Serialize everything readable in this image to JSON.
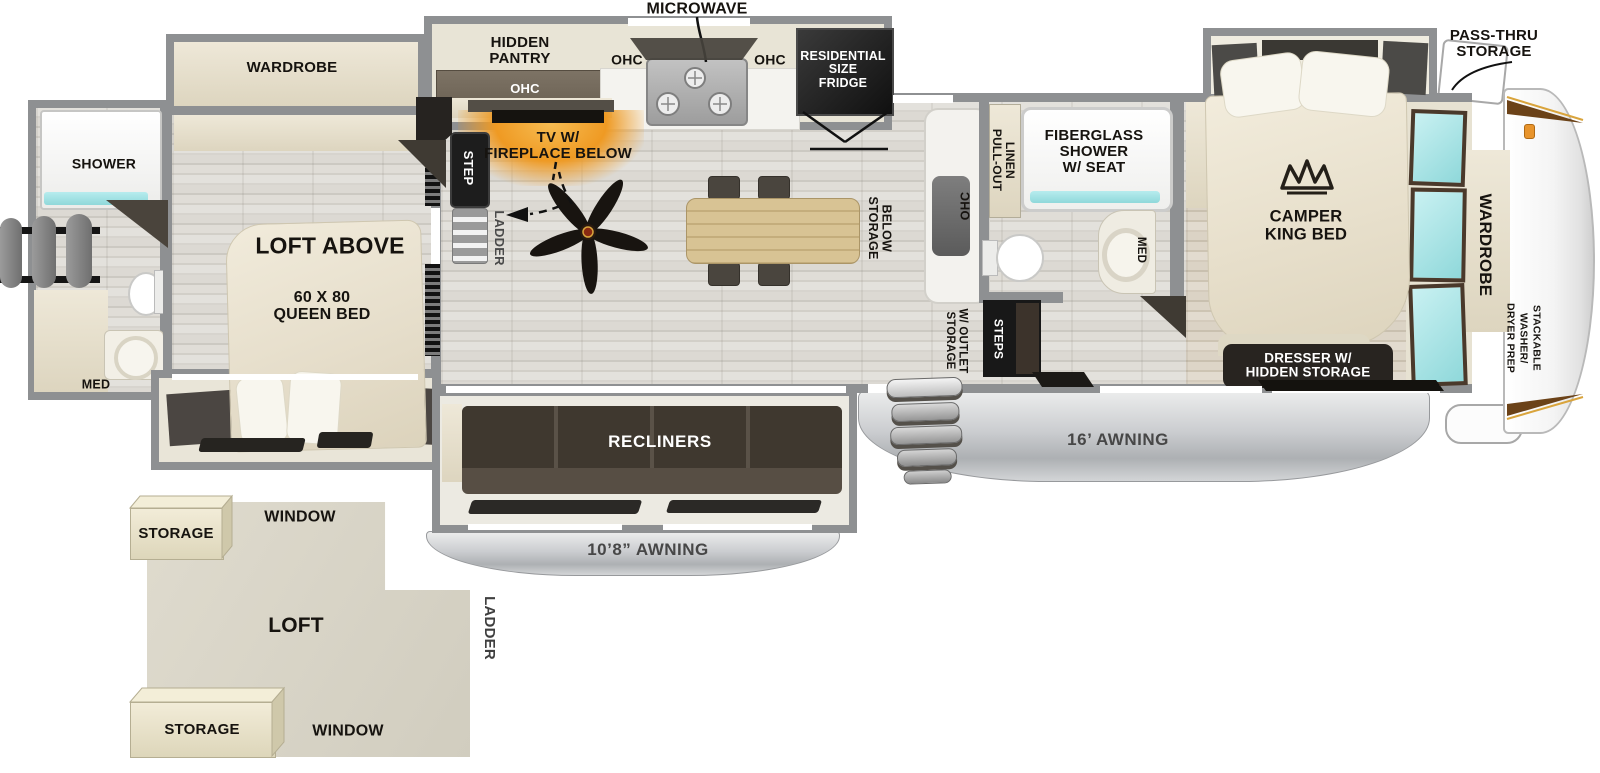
{
  "colors": {
    "wall": "#8e9092",
    "accent_orange": "#e8942c",
    "glow_orange": "#f09a28",
    "cyan": "#9fe2e4",
    "black_box": "#1c1c1c",
    "awning_text": "#474747"
  },
  "top_labels": {
    "microwave": "MICROWAVE",
    "pass_thru": "PASS-THRU\nSTORAGE"
  },
  "kitchen": {
    "hidden_pantry": "HIDDEN\nPANTRY",
    "ohc": "OHC",
    "fridge": "RESIDENTIAL\nSIZE\nFRIDGE",
    "tv_fireplace": "TV W/\nFIREPLACE BELOW",
    "storage_below": "STORAGE\nBELOW"
  },
  "living": {
    "recliners": "RECLINERS",
    "awning_small": "10’8” AWNING",
    "awning_large": "16’ AWNING",
    "step": "STEP",
    "ladder": "LADDER"
  },
  "bath": {
    "pull_out_linen": "PULL-OUT\nLINEN",
    "shower": "FIBERGLASS\nSHOWER\nW/ SEAT",
    "med": "MED",
    "steps": "STEPS",
    "storage_outlet": "STORAGE\nW/ OUTLET"
  },
  "bedroom": {
    "bed": "CAMPER\nKING BED",
    "dresser": "DRESSER W/\nHIDDEN STORAGE",
    "wardrobe": "WARDROBE",
    "washer_prep": "STACKABLE\nWASHER/\nDRYER PREP"
  },
  "rear": {
    "wardrobe": "WARDROBE",
    "shower": "SHOWER",
    "med": "MED",
    "loft_above": "LOFT ABOVE",
    "queen_bed": "60 X 80\nQUEEN BED"
  },
  "loft": {
    "name": "LOFT",
    "window_top": "WINDOW",
    "window_bottom": "WINDOW",
    "storage_top": "STORAGE",
    "storage_bottom": "STORAGE",
    "ladder": "LADDER"
  }
}
